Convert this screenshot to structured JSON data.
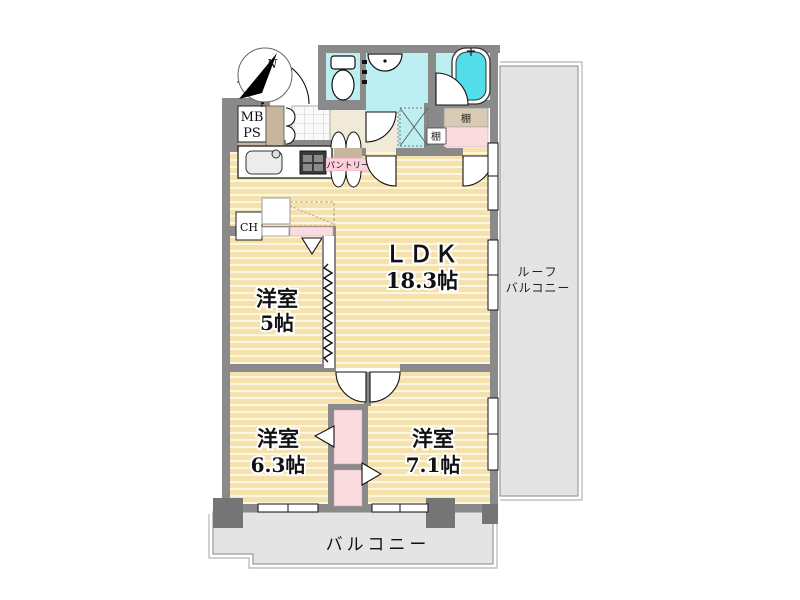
{
  "plan_title": "2LDK apartment floor plan",
  "compass": {
    "north_label": "N"
  },
  "rooms": {
    "ldk": {
      "name": "ＬＤＫ",
      "size": "18.3帖"
    },
    "bedroom5": {
      "name": "洋室",
      "size": "5帖"
    },
    "bedroom63": {
      "name": "洋室",
      "size": "6.3帖"
    },
    "bedroom71": {
      "name": "洋室",
      "size": "7.1帖"
    }
  },
  "outdoor": {
    "roof_balcony_line1": "ルーフ",
    "roof_balcony_line2": "バルコニー",
    "balcony": "バルコニー"
  },
  "fixtures": {
    "meter_box": "MB",
    "pipe_space": "PS",
    "ch_box": "CH",
    "shelf_upper": "棚",
    "shelf_lower": "棚",
    "pantry": "パントリー"
  },
  "colors": {
    "wall": "#8a8a8a",
    "pillar": "#757575",
    "floor_tan": "#f4e1ab",
    "wet_cyan": "#bdeef2",
    "tub_cyan": "#52dde8",
    "closet_pink": "#fadbe0",
    "pantry_pink": "#fbd0dc",
    "hall_beige": "#f2ead8",
    "step_brown": "#c7b69e",
    "balcony_gray": "#e4e4e4",
    "tile_white": "#fafafa"
  }
}
